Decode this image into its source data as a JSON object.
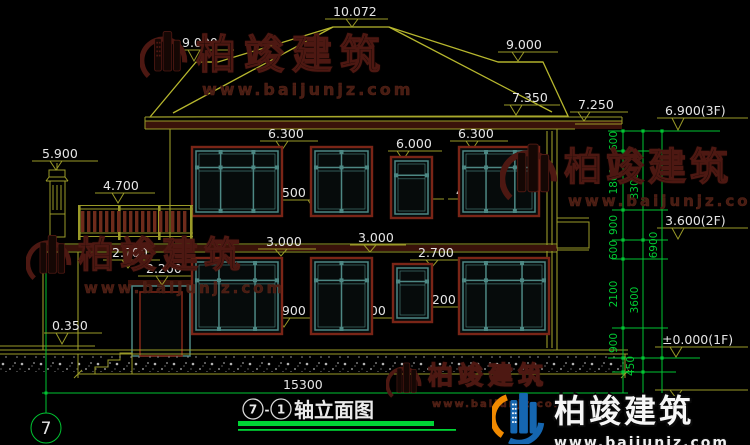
{
  "drawing": {
    "title": {
      "axis_start": "7",
      "separator": "-",
      "axis_end": "1",
      "name": "轴立面图"
    },
    "axis_bubble": "7",
    "total_width_dim": "15300",
    "levels": {
      "ridge": "10.072",
      "left_roof": "9.000",
      "right_roof": "9.000",
      "eave_upper": "7.350",
      "eave_gutter": "7.250",
      "chimney_top": "5.900",
      "railing_top": "4.700",
      "f2_win_top_left": "6.300",
      "f2_win_top_mid": "6.000",
      "f2_win_top_right": "6.300",
      "f2_sill_left": "4.500",
      "f2_sill_mid": "4.500",
      "f2_sill_right": "4.500",
      "f2_floor_left": "3.000",
      "f2_floor_right": "3.000",
      "f1_win_top_left": "2.700",
      "f1_win_top_right": "2.700",
      "door_top": "2.200",
      "f1_sill_small": "1.200",
      "f1_sill_left": "0.900",
      "f1_sill_right": "0.900",
      "terrace": "0.350",
      "floor3": "6.900(3F)",
      "floor2": "3.600(2F)",
      "floor1": "±0.000(1F)"
    },
    "chain": {
      "inner": [
        "600",
        "1800",
        "900",
        "600",
        "2100",
        "900",
        "450"
      ],
      "mid": [
        "3300",
        "3600"
      ],
      "total": "6900"
    }
  },
  "watermark": {
    "brand": "柏竣建筑",
    "url": "www.baijunjz.com"
  }
}
